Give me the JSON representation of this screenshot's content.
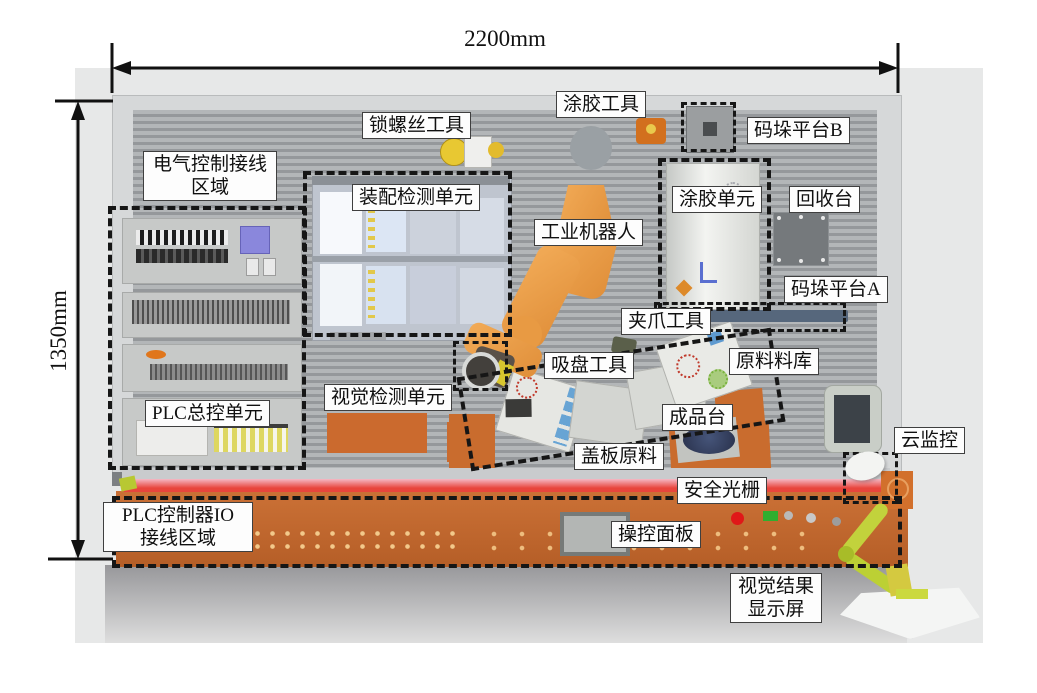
{
  "dimensions": {
    "width": "2200mm",
    "height": "1350mm"
  },
  "callouts": {
    "screw_tool": "锁螺丝工具",
    "glue_tool": "涂胶工具",
    "pallet_platform_b": "码垛平台B",
    "electrical_wiring_area": "电气控制接线\n区域",
    "assembly_inspection_unit": "装配检测单元",
    "industrial_robot": "工业机器人",
    "glue_unit": "涂胶单元",
    "recycling_station": "回收台",
    "pallet_platform_a": "码垛平台A",
    "gripper_tool": "夹爪工具",
    "suction_tool": "吸盘工具",
    "raw_material_store": "原料料库",
    "finished_product_station": "成品台",
    "cover_plate_material": "盖板原料",
    "plc_master_control_unit": "PLC总控单元",
    "vision_inspection_unit": "视觉检测单元",
    "safety_light_curtain": "安全光栅",
    "plc_io_wiring_area": "PLC控制器IO\n接线区域",
    "control_panel": "操控面板",
    "cloud_monitoring": "云监控",
    "vision_result_display": "视觉结果\n显示屏"
  },
  "colors": {
    "bench_orange": "#c96f33",
    "robot_orange": "#eda04f",
    "light_curtain_red": "#e8453c",
    "pallet_a_blue": "#56677c",
    "arm_yellow_green": "#c2d23c",
    "wall_gray": "#a5a8ab",
    "dash_black": "#161616"
  }
}
